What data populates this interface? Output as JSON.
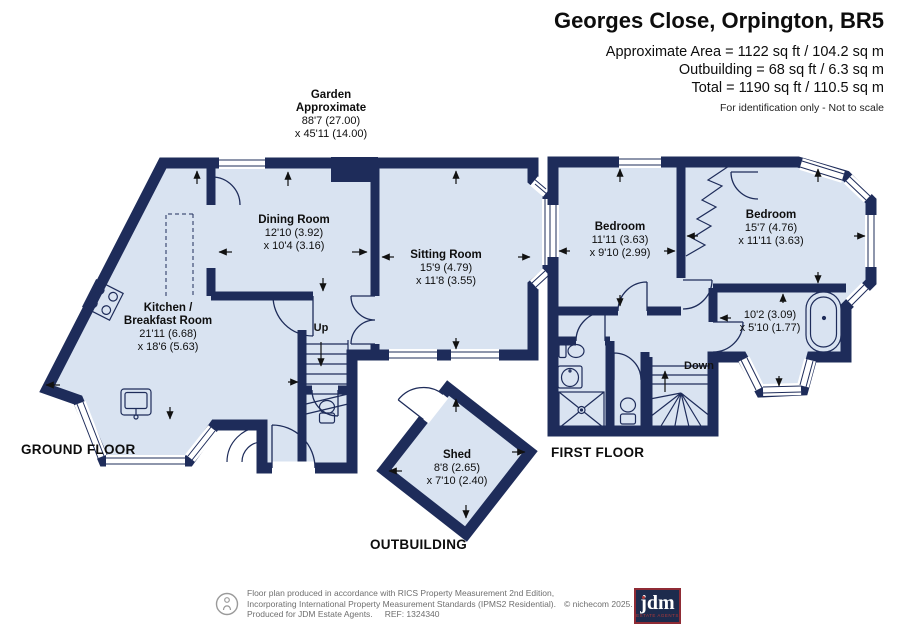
{
  "header": {
    "title": "Georges Close, Orpington, BR5",
    "line1": "Approximate Area = 1122 sq ft / 104.2 sq m",
    "line2": "Outbuilding = 68 sq ft / 6.3 sq m",
    "line3": "Total = 1190 sq ft / 110.5 sq m",
    "disclaimer": "For identification only - Not to scale"
  },
  "garden": {
    "line1": "Garden",
    "line2": "Approximate",
    "dim1": "88'7 (27.00)",
    "dim2": "x 45'11 (14.00)"
  },
  "rooms": {
    "dining": {
      "name": "Dining Room",
      "dim1": "12'10 (3.92)",
      "dim2": "x 10'4 (3.16)"
    },
    "sitting": {
      "name": "Sitting Room",
      "dim1": "15'9 (4.79)",
      "dim2": "x 11'8 (3.55)"
    },
    "kitchen": {
      "name1": "Kitchen /",
      "name2": "Breakfast Room",
      "dim1": "21'11 (6.68)",
      "dim2": "x 18'6 (5.63)"
    },
    "bedroom1": {
      "name": "Bedroom",
      "dim1": "11'11 (3.63)",
      "dim2": "x 9'10 (2.99)"
    },
    "bedroom2": {
      "name": "Bedroom",
      "dim1": "15'7 (4.76)",
      "dim2": "x 11'11 (3.63)"
    },
    "bathroom": {
      "dim1": "10'2 (3.09)",
      "dim2": "x 5'10 (1.77)"
    },
    "shed": {
      "name": "Shed",
      "dim1": "8'8 (2.65)",
      "dim2": "x 7'10 (2.40)"
    }
  },
  "stairs": {
    "up": "Up",
    "down": "Down"
  },
  "floors": {
    "ground": "GROUND FLOOR",
    "first": "FIRST FLOOR",
    "outbuilding": "OUTBUILDING"
  },
  "footer": {
    "line1": "Floor plan produced in accordance with RICS Property Measurement 2nd Edition,",
    "line2": "Incorporating International Property Measurement Standards (IPMS2 Residential).",
    "copyright": "© nichecom 2025.",
    "line3": "Produced for JDM Estate Agents.",
    "ref": "REF: 1324340",
    "logo_text": "jdm",
    "logo_subtext": "ESTATE AGENTS"
  },
  "colors": {
    "wall": "#1e2c5a",
    "floor": "#d9e3f1",
    "window": "#ffffff",
    "logo_red": "#b03a3a"
  }
}
